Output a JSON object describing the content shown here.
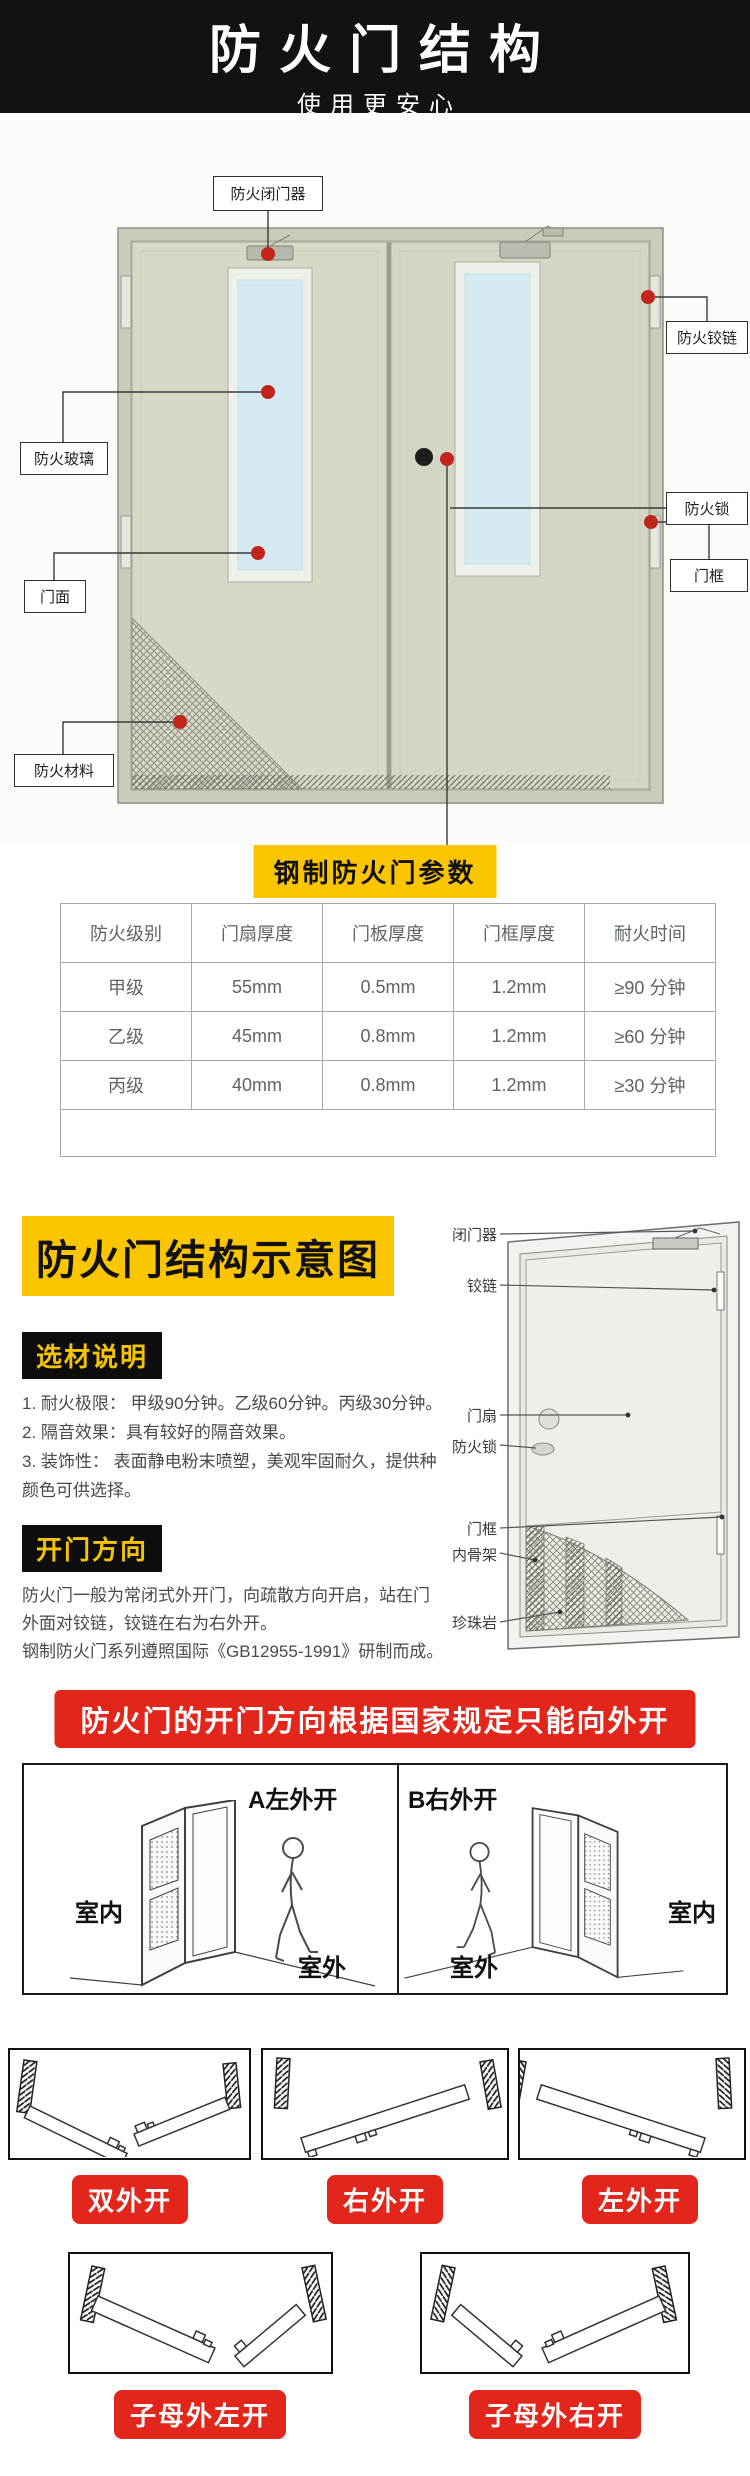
{
  "header": {
    "title": "防火门结构",
    "subtitle": "使用更安心"
  },
  "door_diagram": {
    "labels": {
      "closer": "防火闭门器",
      "hinge": "防火铰链",
      "glass": "防火玻璃",
      "lock": "防火锁",
      "face": "门面",
      "frame": "门框",
      "material": "防火材料"
    }
  },
  "params": {
    "title": "钢制防火门参数",
    "table": {
      "headers": [
        "防火级别",
        "门扇厚度",
        "门板厚度",
        "门框厚度",
        "耐火时间"
      ],
      "rows": [
        [
          "甲级",
          "55mm",
          "0.5mm",
          "1.2mm",
          "≥90 分钟"
        ],
        [
          "乙级",
          "45mm",
          "0.8mm",
          "1.2mm",
          "≥60 分钟"
        ],
        [
          "丙级",
          "40mm",
          "0.8mm",
          "1.2mm",
          "≥30 分钟"
        ]
      ]
    }
  },
  "schematic": {
    "title": "防火门结构示意图",
    "material_section": {
      "heading": "选材说明",
      "items": [
        "1. 耐火极限： 甲级90分钟。乙级60分钟。丙级30分钟。",
        "2. 隔音效果：具有较好的隔音效果。",
        "3. 装饰性：  表面静电粉末喷塑，美观牢固耐久，提供种颜色可供选择。"
      ]
    },
    "direction_section": {
      "heading": "开门方向",
      "paragraphs": [
        "防火门一般为常闭式外开门，向疏散方向开启，站在门外面对铰链，铰链在右为右外开。",
        "钢制防火门系列遵照国际《GB12955-1991》研制而成。"
      ]
    },
    "diagram_labels": [
      "闭门器",
      "铰链",
      "门扇",
      "防火锁",
      "门框",
      "内骨架",
      "珍珠岩"
    ]
  },
  "regulation_banner": "防火门的开门方向根据国家规定只能向外开",
  "direction_examples": {
    "panel_a": {
      "title": "A左外开",
      "inside_label": "室内",
      "outside_label": "室外"
    },
    "panel_b": {
      "title": "B右外开",
      "inside_label": "室内",
      "outside_label": "室外"
    }
  },
  "opening_types": {
    "row1": [
      {
        "label": "双外开"
      },
      {
        "label": "右外开"
      },
      {
        "label": "左外开"
      }
    ],
    "row2": [
      {
        "label": "子母外左开"
      },
      {
        "label": "子母外右开"
      }
    ]
  },
  "colors": {
    "header_bg": "#121212",
    "accent_yellow": "#FBC600",
    "accent_red": "#E2261B",
    "marker_red": "#C2251C",
    "door_leaf": "#D7D9C8",
    "glass_blue": "#D6EBF1"
  }
}
